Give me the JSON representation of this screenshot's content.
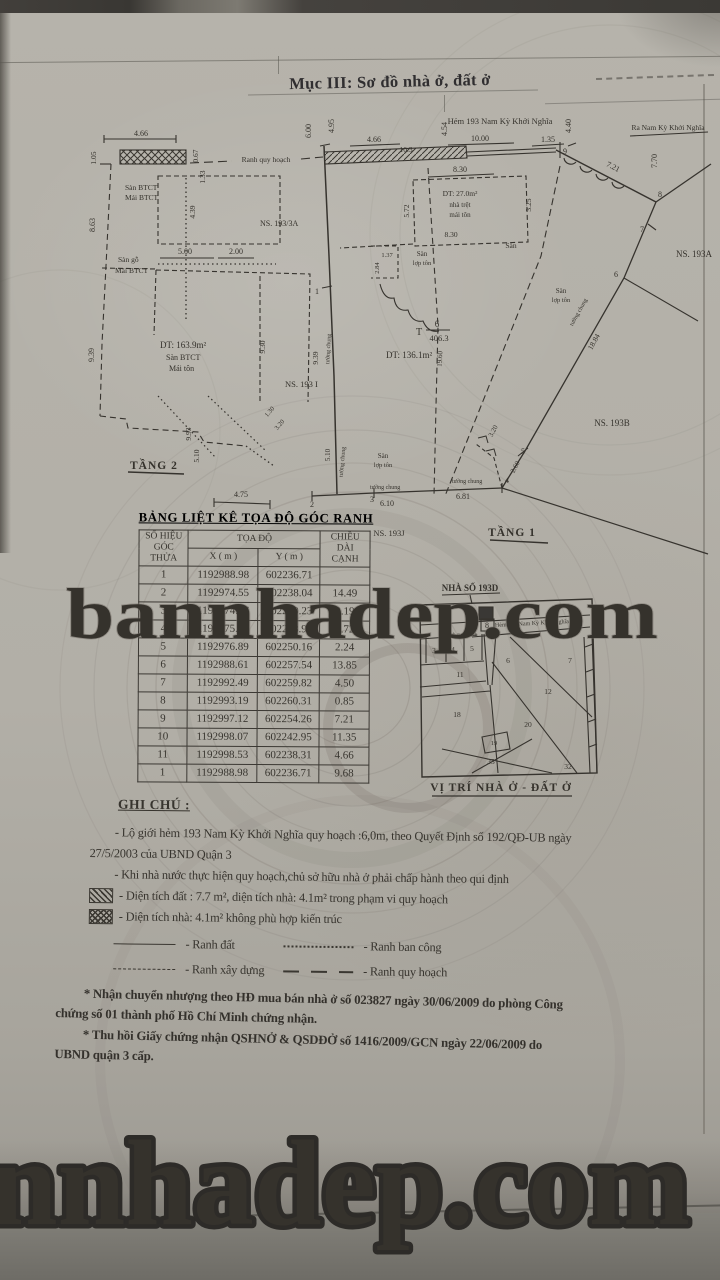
{
  "document": {
    "section_title": "Mục III: Sơ đồ nhà ở, đất ở"
  },
  "plan": {
    "street_label": "Hẻm 193 Nam Kỳ Khởi Nghĩa",
    "street_exit_label": "Ra Nam Kỳ Khởi Nghĩa",
    "planning_boundary_label": "Ranh quy hoạch",
    "floor2_label": "TẦNG 2",
    "floor1_label": "TẦNG 1",
    "neighbor_193_3a": "NS. 193/3A",
    "neighbor_193a": "NS. 193A",
    "neighbor_193b": "NS. 193B",
    "neighbor_193i": "NS. 193 I",
    "neighbor_193j": "NS. 193J",
    "area_floor2": {
      "dt": "DT: 163.9m²",
      "l2": "Sàn BTCT",
      "l3": "Mái tôn"
    },
    "area_house": {
      "dt": "DT: 27.0m²",
      "l2": "nhà trệt",
      "l3": "mái tôn"
    },
    "area_land": "DT: 136.1m²",
    "parcel": {
      "prefix": "T",
      "numerator": "6",
      "denominator": "406.3"
    },
    "label_san_btct": "Sàn BTCT",
    "label_mai_btct": "Mái BTCT",
    "label_san_go": "Sàn gỗ",
    "label_san": "Sàn",
    "label_lop_ton": "lợp tôn",
    "label_tuong_chung": "tường chung",
    "dims": [
      "4.66",
      "1.05",
      "0.67",
      "1.33",
      "6.00",
      "4.95",
      "4.66",
      "10.3",
      "4.54",
      "10.00",
      "1.35",
      "4.40",
      "7.70",
      "7.21",
      "8.30",
      "5.72",
      "3.25",
      "8.30",
      "1.37",
      "2.84",
      "8.63",
      "5.00",
      "2.00",
      "4.39",
      "9.39",
      "9.30",
      "9.93",
      "5.10",
      "1.30",
      "3.20",
      "4.75",
      "9.39",
      "5.10",
      "19.60",
      "6.10",
      "6.81",
      "2.60",
      "3.20",
      "18.84"
    ],
    "points": [
      "1",
      "2",
      "3",
      "4",
      "5",
      "6",
      "7",
      "8",
      "9"
    ]
  },
  "table": {
    "title": "BẢNG LIỆT KÊ TỌA ĐỘ GÓC RANH",
    "h_corner_1": "SỐ HIỆU",
    "h_corner_2": "GÓC THỬA",
    "h_coord": "TỌA ĐỘ",
    "h_x": "X ( m )",
    "h_y": "Y ( m )",
    "h_len_1": "CHIỀU DÀI",
    "h_len_2": "CẠNH",
    "rows": [
      [
        "1",
        "1192988.98",
        "602236.71",
        ""
      ],
      [
        "2",
        "1192974.55",
        "602238.04",
        "14.49"
      ],
      [
        "3",
        "1192974.67",
        "602240.23",
        "2.19"
      ],
      [
        "4",
        "1192975.01",
        "602248.94",
        "8.72"
      ],
      [
        "5",
        "1192976.89",
        "602250.16",
        "2.24"
      ],
      [
        "6",
        "1192988.61",
        "602257.54",
        "13.85"
      ],
      [
        "7",
        "1192992.49",
        "602259.82",
        "4.50"
      ],
      [
        "8",
        "1192993.19",
        "602260.31",
        "0.85"
      ],
      [
        "9",
        "1192997.12",
        "602254.26",
        "7.21"
      ],
      [
        "10",
        "1192998.07",
        "602242.95",
        "11.35"
      ],
      [
        "11",
        "1192998.53",
        "602238.31",
        "4.66"
      ],
      [
        "1",
        "1192988.98",
        "602236.71",
        "9.68"
      ]
    ]
  },
  "site_map": {
    "house_label": "NHÀ SỐ 193D",
    "street_label": "Hẻm 193 Nam Kỳ Khởi Nghĩa",
    "boundary_label": "Ranh quy hoạch",
    "caption": "VỊ TRÍ NHÀ Ở - ĐẤT Ở",
    "parcels": [
      "3",
      "4",
      "5",
      "8",
      "6",
      "7",
      "11",
      "12",
      "18",
      "19",
      "20",
      "33",
      "32"
    ]
  },
  "notes": {
    "heading": "GHI CHÚ :",
    "item1": "- Lộ giới hẻm 193 Nam Kỳ Khởi Nghĩa quy hoạch :6,0m,  theo Quyết Định số 192/QĐ-UB ngày 27/5/2003 của UBND Quận 3",
    "item2": "- Khi nhà nước thực hiện quy hoạch,chủ sở hữu nhà ở phải chấp hành theo qui định",
    "item3": "- Diện tích đất : 7.7 m², diện tích nhà: 4.1m² trong phạm vi quy hoạch",
    "item4": "- Diện tích nhà: 4.1m² không phù hợp kiến trúc",
    "legend": {
      "land": "- Ranh đất",
      "balcony": "- Ranh ban công",
      "building": "- Ranh xây dựng",
      "planning": "- Ranh quy hoạch"
    }
  },
  "footer": {
    "note1": "* Nhận chuyển nhượng theo HĐ mua bán nhà ở số 023827 ngày 30/06/2009 do phòng Công chứng số 01 thành phố Hồ Chí Minh chứng nhận.",
    "note2": "* Thu hồi Giấy chứng nhận QSHNỞ & QSDĐỞ số 1416/2009/GCN ngày 22/06/2009 do UBND quận 3 cấp."
  },
  "watermarks": {
    "middle": "bannhadep.com",
    "bottom": "nnhadep.com"
  }
}
